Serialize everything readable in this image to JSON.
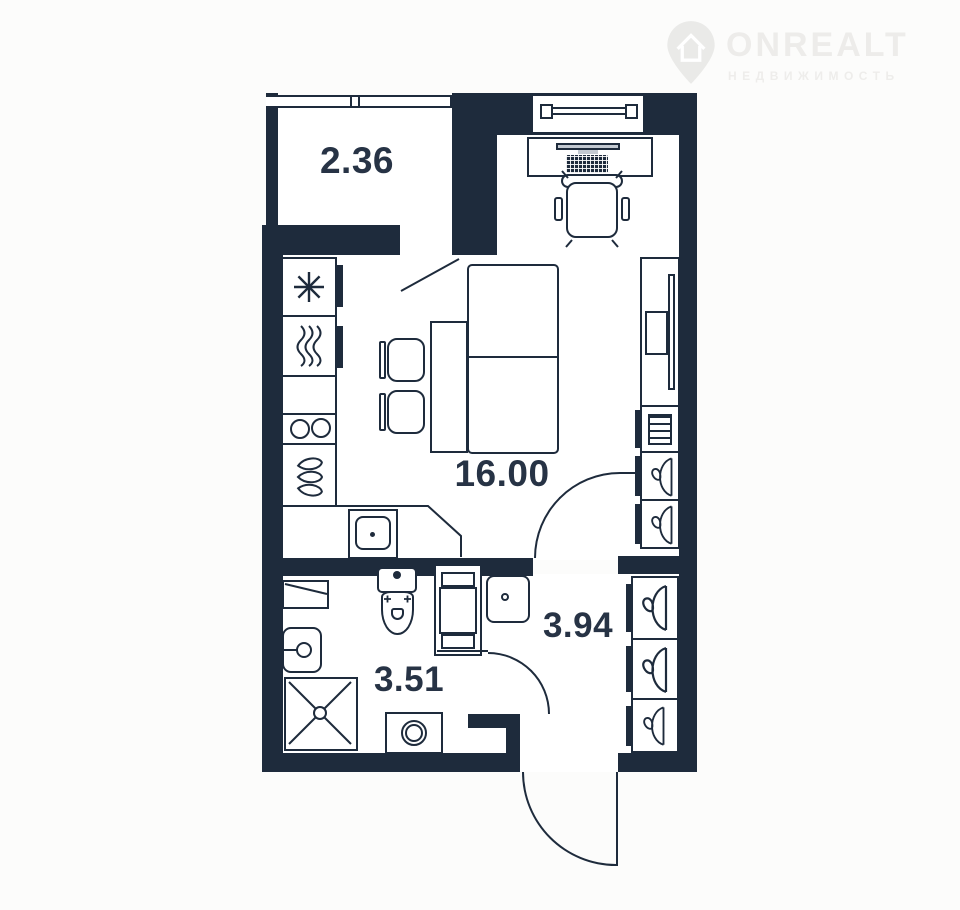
{
  "logo": {
    "brand": "ONREALT",
    "subtitle": "НЕДВИЖИМОСТЬ"
  },
  "plan": {
    "rooms": [
      {
        "name": "balcony",
        "area": "2.36"
      },
      {
        "name": "living-room",
        "area": "16.00"
      },
      {
        "name": "hallway",
        "area": "3.94"
      },
      {
        "name": "bathroom",
        "area": "3.51"
      }
    ]
  },
  "colors": {
    "wall": "#1e2b3c",
    "floor": "#ffffff",
    "background": "#fcfcfb",
    "label": "#273345",
    "logo": "#edecea"
  },
  "icons": {
    "location-pin-icon": "map pin with house",
    "snowflake-icon": "fridge",
    "steam-icon": "oven",
    "burners-icon": "two-ring hob",
    "drops-icon": "drainer",
    "sink-icon": "kitchen sink",
    "hanger-icon": "wardrobe hanger",
    "monitor-icon": "desk monitor",
    "keyboard-icon": "keyboard",
    "toilet-icon": "toilet",
    "washer-icon": "washing machine",
    "shower-icon": "shower tray",
    "door-arc-icon": "door swing"
  }
}
